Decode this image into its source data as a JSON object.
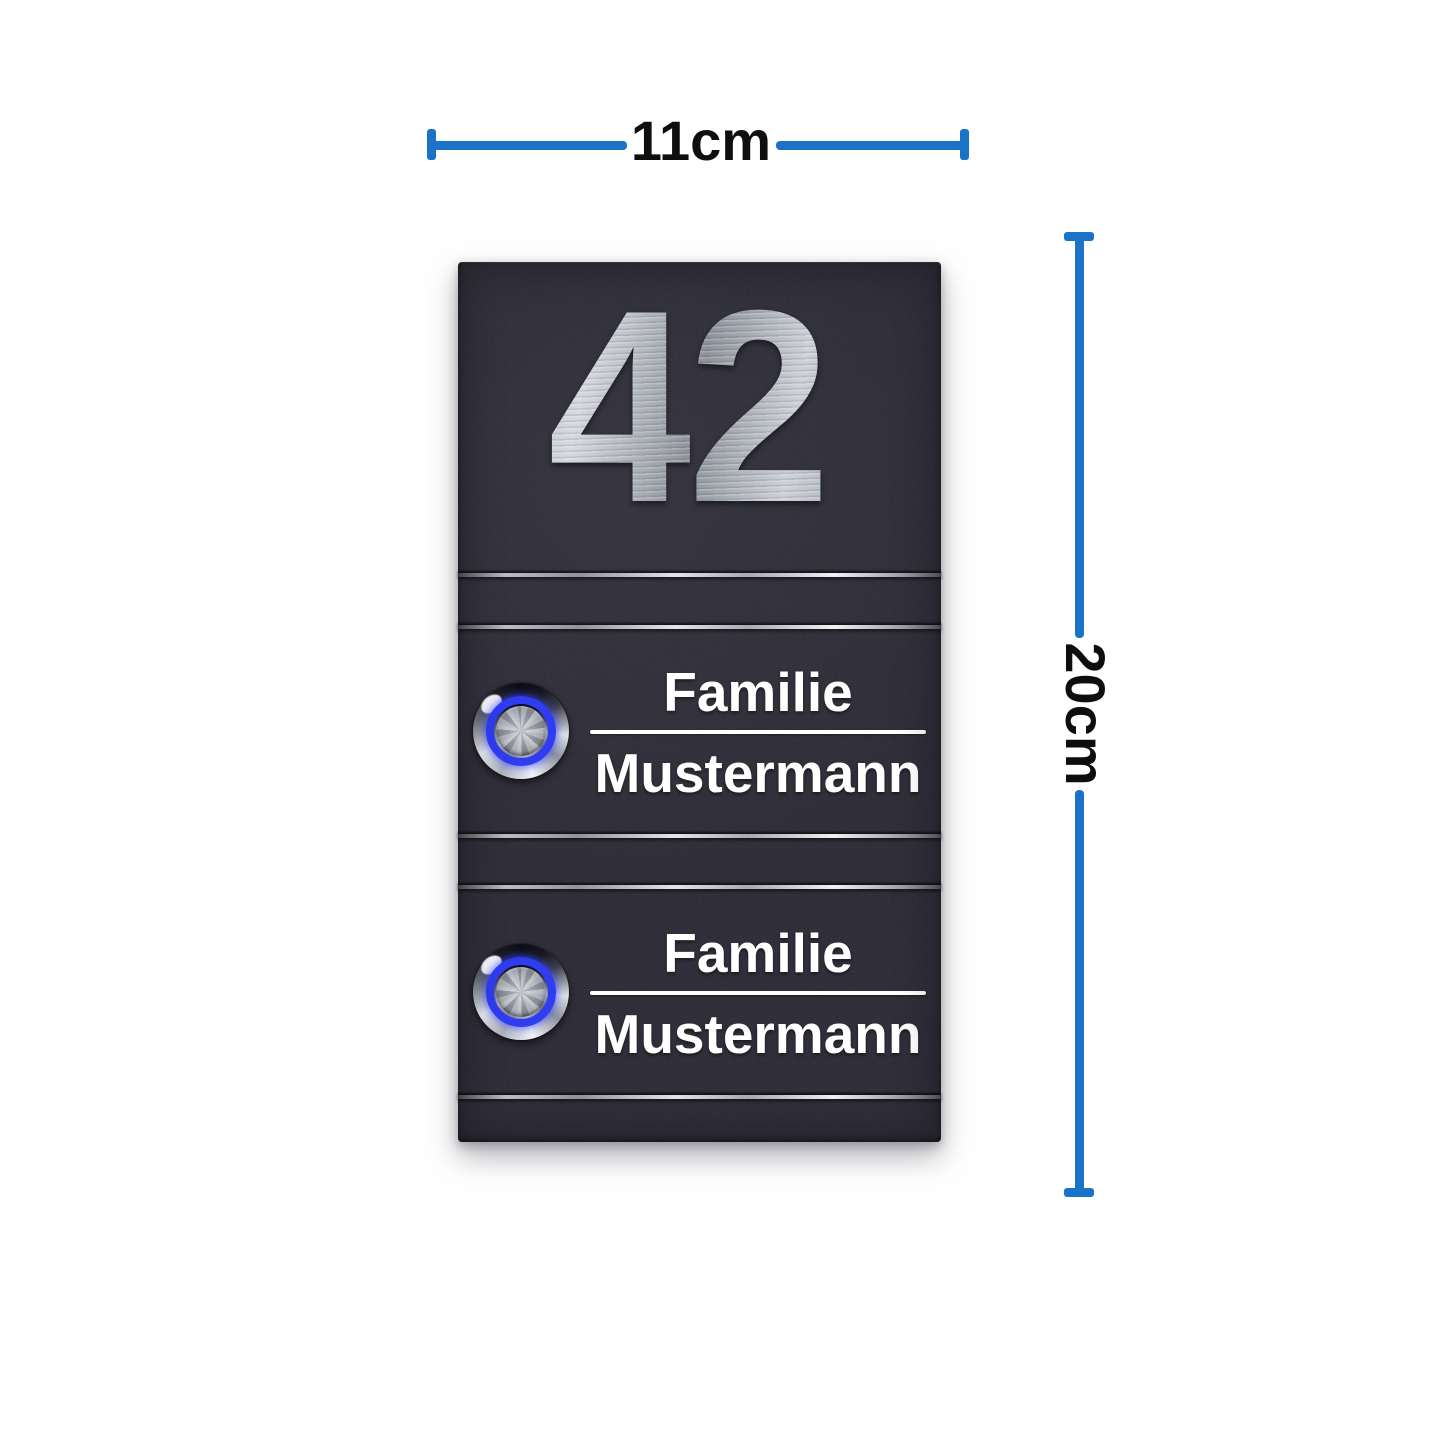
{
  "dimensions": {
    "width_label": "11cm",
    "height_label": "20cm"
  },
  "plate": {
    "house_number": "42",
    "units": [
      {
        "line1": "Familie",
        "line2": "Mustermann"
      },
      {
        "line1": "Familie",
        "line2": "Mustermann"
      }
    ]
  },
  "colors": {
    "dimension_blue": "#1b73c8",
    "label_black": "#0e0e0e",
    "plate_anthracite": "#272632",
    "led_blue": "#2f3cf0",
    "name_white": "#ffffff",
    "steel_silver": "#c7cbd2"
  },
  "icons": {
    "doorbell_button": "led-doorbell-button",
    "dimension_endcap": "measure-endcap"
  }
}
